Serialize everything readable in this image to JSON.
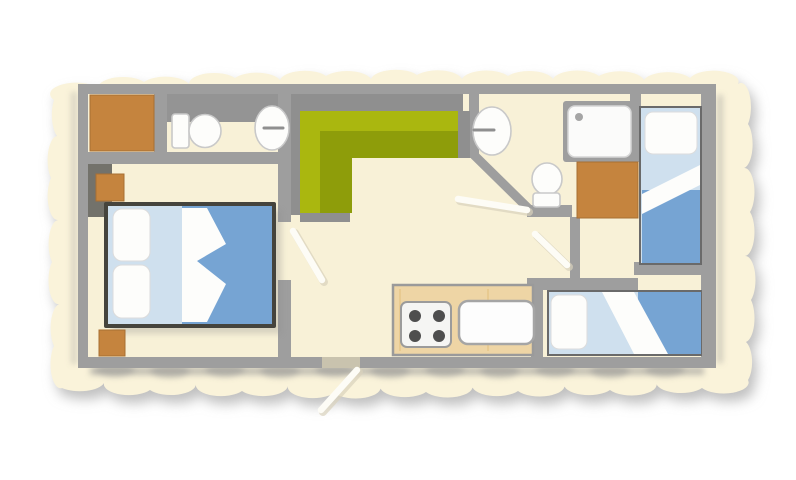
{
  "meta": {
    "title": "Mobile home floor plan",
    "type": "architectural-floor-plan",
    "view": "top-down",
    "text_labels": "none"
  },
  "colors": {
    "page": "#ffffff",
    "paper": "#faf3da",
    "floor": "#f8f1d7",
    "wall": "#9e9e9e",
    "wall_dark": "#73726b",
    "shelf": "#949494",
    "wood": "#c5843e",
    "wood_edge": "#a86f33",
    "bed_frame": "#45443d",
    "duvet": "#76a4d3",
    "sheet": "#cfe0ee",
    "linen": "#fdfdfb",
    "fixture": "#fdfdfb",
    "fixture_edge": "#c9c9c9",
    "sofa_back": "#8f8f8f",
    "sofa_green": "#aab70f",
    "sofa_green_dark": "#8e9d0a",
    "counter": "#eed5a5",
    "counter_edge": "#9a9a9a",
    "burner": "#4e4e4e",
    "door_leaf": "#fdfcf6",
    "door_shadow": "#d8d2bc",
    "shadow": "#8d8d8d"
  },
  "rooms": [
    {
      "id": "master-bedroom",
      "position": "left",
      "furniture": [
        "wardrobe",
        "nightstand",
        "double-bed",
        "nightstand"
      ]
    },
    {
      "id": "wc",
      "position": "top-left",
      "furniture": [
        "wall-shelf",
        "toilet",
        "washbasin"
      ]
    },
    {
      "id": "living-kitchen",
      "position": "center",
      "furniture": [
        "corner-sofa",
        "kitchen-counter",
        "hob-4-burner",
        "sink"
      ]
    },
    {
      "id": "bathroom",
      "position": "top-right-center",
      "furniture": [
        "washbasin",
        "shower",
        "toilet"
      ]
    },
    {
      "id": "kids-bedroom-right",
      "position": "right",
      "furniture": [
        "wardrobe",
        "single-bed"
      ]
    },
    {
      "id": "kids-bedroom-bottom",
      "position": "bottom-right",
      "furniture": [
        "single-bed"
      ]
    }
  ],
  "doors": {
    "interior_count": 3,
    "entrance_count": 1,
    "entrance_position": "bottom-center"
  }
}
